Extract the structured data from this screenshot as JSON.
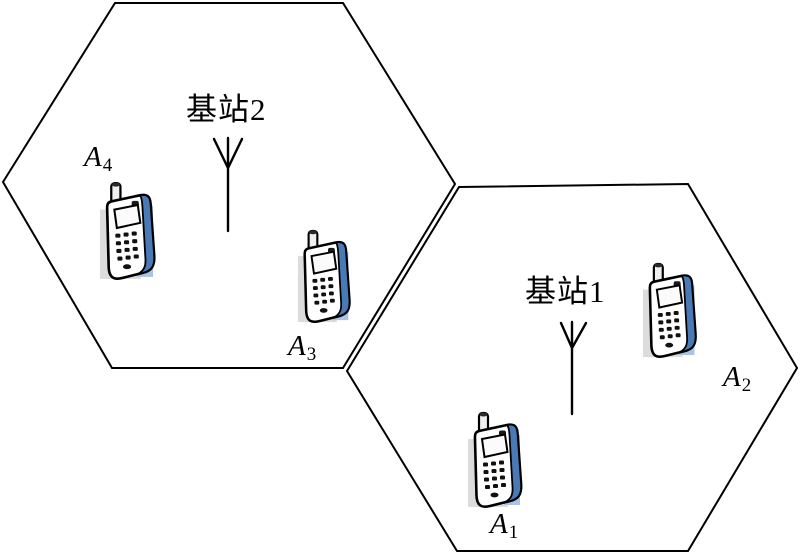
{
  "figure": {
    "type": "cellular-network-diagram",
    "background": "#ffffff",
    "line_color": "#000000"
  },
  "cells": {
    "cell2": {
      "base_station_label": "基站2"
    },
    "cell1": {
      "base_station_label": "基站1"
    }
  },
  "phones": {
    "a4": {
      "base": "A",
      "sub": "4"
    },
    "a3": {
      "base": "A",
      "sub": "3"
    },
    "a1": {
      "base": "A",
      "sub": "1"
    },
    "a2": {
      "base": "A",
      "sub": "2"
    }
  },
  "colors": {
    "phone_side_blue": "#4a7ab5",
    "phone_shadow_blue": "#a9c5e6",
    "phone_shadow_gray": "#dcdcdc"
  }
}
